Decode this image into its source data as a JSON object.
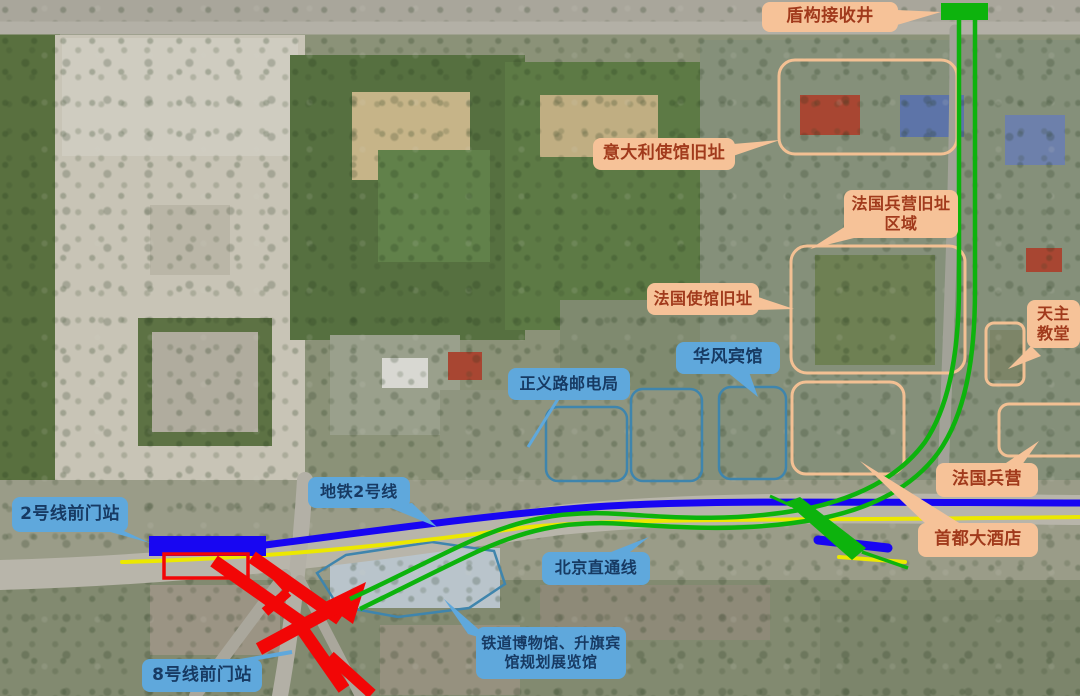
{
  "map": {
    "title": "前门地区盾构区间与车站规划卫星示意图",
    "labels": {
      "shield_shaft": "盾构接收井",
      "italian_embassy": "意大利使馆旧址",
      "french_barracks_area": "法国兵营旧址区域",
      "french_embassy": "法国使馆旧址",
      "catholic_church": "天主教堂",
      "huafeng_hotel": "华风宾馆",
      "zhengyi_post_office": "正义路邮电局",
      "french_barracks": "法国兵营",
      "metro_line2": "地铁2号线",
      "line2_qianmen_station": "2号线前门站",
      "beijing_through_line": "北京直通线",
      "capital_hotel": "首都大酒店",
      "railway_museum": "铁道博物馆、升旗宾馆规划展览馆",
      "line8_qianmen_station": "8号线前门站"
    },
    "colors": {
      "heritage_label_bg": "#f6c298",
      "heritage_label_text": "#a13a1c",
      "facility_label_bg": "#5fa8dc",
      "facility_label_text": "#173a63",
      "shield_route_green": "#0db30d",
      "metro_line2_blue": "#1806f2",
      "through_line_yellow": "#ece800",
      "line8_structure_red": "#f20606",
      "heritage_region_outline": "#f3c093",
      "building_group_outline": "#3f85ad"
    }
  }
}
